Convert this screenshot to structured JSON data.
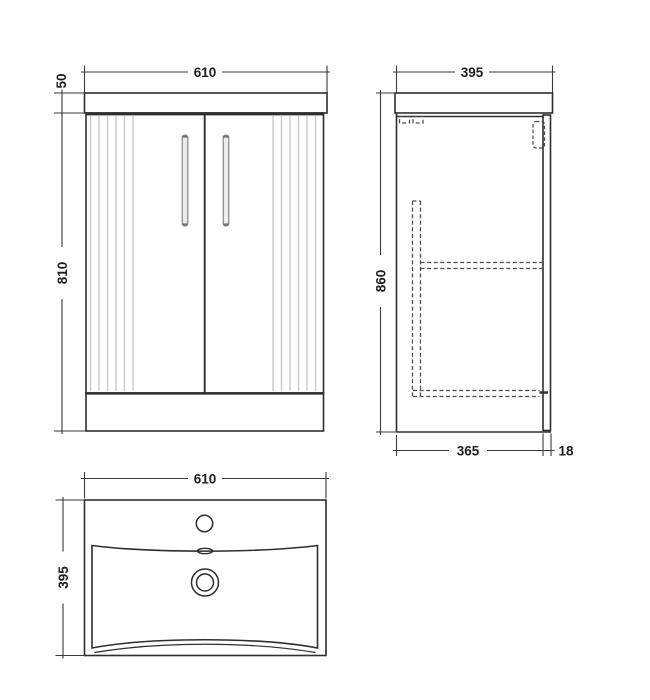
{
  "drawing": {
    "front_view": {
      "width_label": "610",
      "worktop_height_label": "50",
      "cabinet_height_label": "810"
    },
    "side_view": {
      "depth_label": "395",
      "height_label": "860",
      "carcass_depth_label": "365",
      "door_projection_label": "18"
    },
    "basin_view": {
      "width_label": "610",
      "depth_label": "395"
    },
    "colors": {
      "line": "#2e2e2e",
      "dimension_line": "#3a3a3a",
      "flute": "#c9c9c9",
      "handle_fill": "#ececec",
      "handle_stroke": "#7d7d7d",
      "background": "#ffffff"
    }
  }
}
